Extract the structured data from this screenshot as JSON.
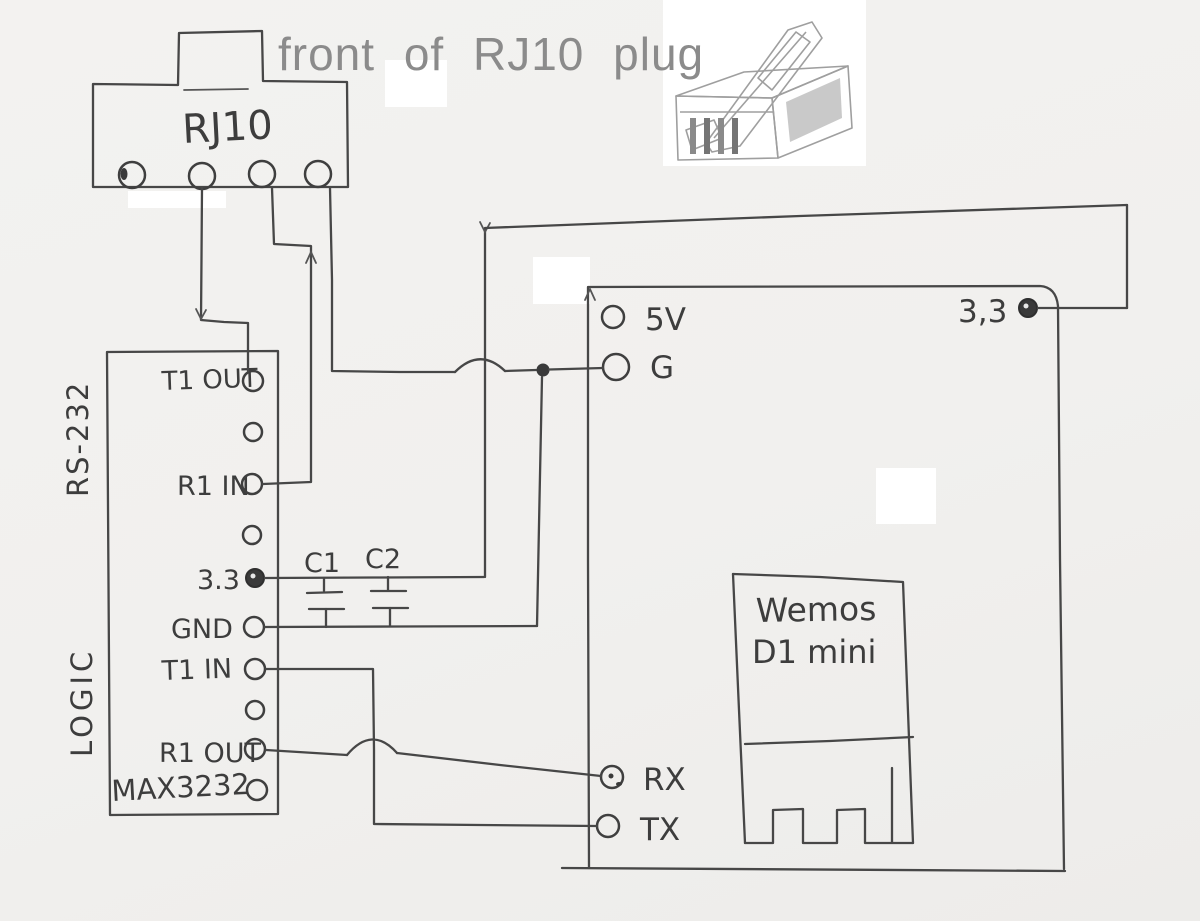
{
  "title": "front of RJ10 plug",
  "colors": {
    "paper": "#f1f0ee",
    "pencil": "#474747",
    "title_gray": "#8b8b8b",
    "whiteout": "#ffffff"
  },
  "rj10": {
    "label": "RJ10",
    "pin_count": 4
  },
  "plug_photo": {
    "description": "grayscale photo of a clear RJ10 plug, latch up-right"
  },
  "max3232": {
    "side_label_top": "RS-232",
    "side_label_bottom": "LOGIC",
    "chip_label": "MAX3232",
    "pin_labels": {
      "t1out": "T1 OUT",
      "r1in": "R1 IN",
      "v33": "3.3",
      "gnd": "GND",
      "t1in": "T1 IN",
      "r1out": "R1 OUT"
    }
  },
  "capacitors": {
    "c1": "C1",
    "c2": "C2"
  },
  "wemos": {
    "board_name_line1": "Wemos",
    "board_name_line2": "D1 mini",
    "pin_labels": {
      "v5": "5V",
      "g": "G",
      "v33": "3,3",
      "rx": "RX",
      "tx": "TX"
    }
  },
  "nets": [
    {
      "from": "RJ10 pin 2",
      "to": "MAX3232 T1 OUT"
    },
    {
      "from": "RJ10 pin 3",
      "to": "MAX3232 R1 IN"
    },
    {
      "from": "RJ10 pin 4",
      "to": "Wemos G and MAX3232 GND"
    },
    {
      "from": "MAX3232 3.3",
      "to": "Wemos 3,3"
    },
    {
      "from": "MAX3232 T1 IN",
      "to": "Wemos TX"
    },
    {
      "from": "MAX3232 R1 OUT",
      "to": "Wemos RX"
    },
    {
      "from": "C1 / C2",
      "to": "across 3.3 and GND rails"
    }
  ]
}
